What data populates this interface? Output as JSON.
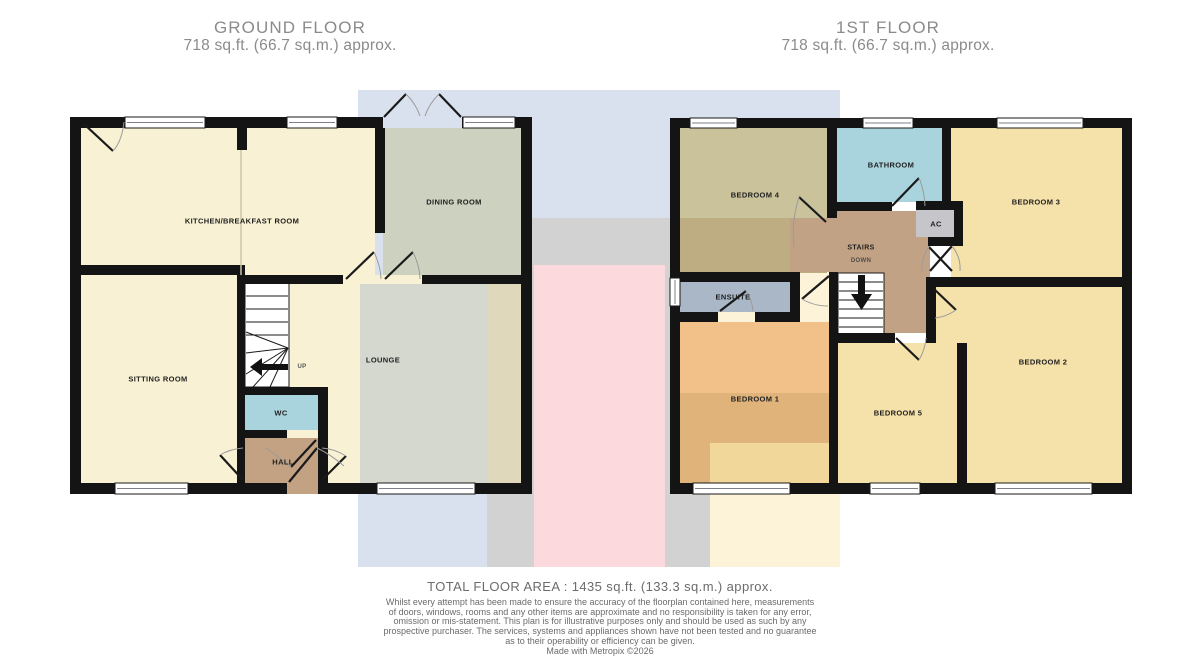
{
  "ground_floor": {
    "title": "GROUND FLOOR",
    "area": "718 sq.ft. (66.7 sq.m.) approx.",
    "labels": {
      "kitchen": "KITCHEN/BREAKFAST ROOM",
      "dining": "DINING ROOM",
      "sitting": "SITTING ROOM",
      "lounge": "LOUNGE",
      "wc": "WC",
      "hall": "HALL",
      "up": "UP"
    }
  },
  "first_floor": {
    "title": "1ST FLOOR",
    "area": "718 sq.ft. (66.7 sq.m.) approx.",
    "labels": {
      "bedroom4": "BEDROOM 4",
      "bathroom": "BATHROOM",
      "bedroom3": "BEDROOM 3",
      "ac": "AC",
      "stairs": "STAIRS",
      "down": "DOWN",
      "ensuite": "ENSUITE",
      "bedroom1": "BEDROOM 1",
      "bedroom5": "BEDROOM 5",
      "bedroom2": "BEDROOM 2"
    }
  },
  "footer": {
    "total_area": "TOTAL FLOOR AREA : 1435 sq.ft. (133.3 sq.m.) approx.",
    "disclaimer_lines": [
      "Whilst every attempt has been made to ensure the accuracy of the floorplan contained here, measurements",
      "of doors, windows, rooms and any other items are approximate and no responsibility is taken for any error,",
      "omission or mis-statement. This plan is for illustrative purposes only and should be used as such by any",
      "prospective purchaser. The services, systems and appliances shown have not been tested and no guarantee",
      "as to their operability or efficiency can be given."
    ],
    "credit": "Made with Metropix ©2026"
  },
  "colors": {
    "wall": "#141414",
    "room_cream": "#f8f1d4",
    "dining_green": "#ccd2bf",
    "bath_blue": "#a9d4dd",
    "hall_brown": "#c3a183",
    "landing_brown": "#c2a284",
    "bedroom1_orange": "#f1c189",
    "bedroom_yellow": "#f5e1aa",
    "bedroom4_olive": "#c9c29b",
    "ensuite_grayblue": "#aab7c7",
    "ac_gray": "#c6c6ca",
    "watermark_blue": "#dae1ee",
    "watermark_gray": "#d2d2d3",
    "watermark_pink": "#fbd9dc",
    "watermark_cream": "#fdf3d9",
    "title_gray": "#8b8b8b",
    "footer_gray": "#6b6b6b"
  }
}
